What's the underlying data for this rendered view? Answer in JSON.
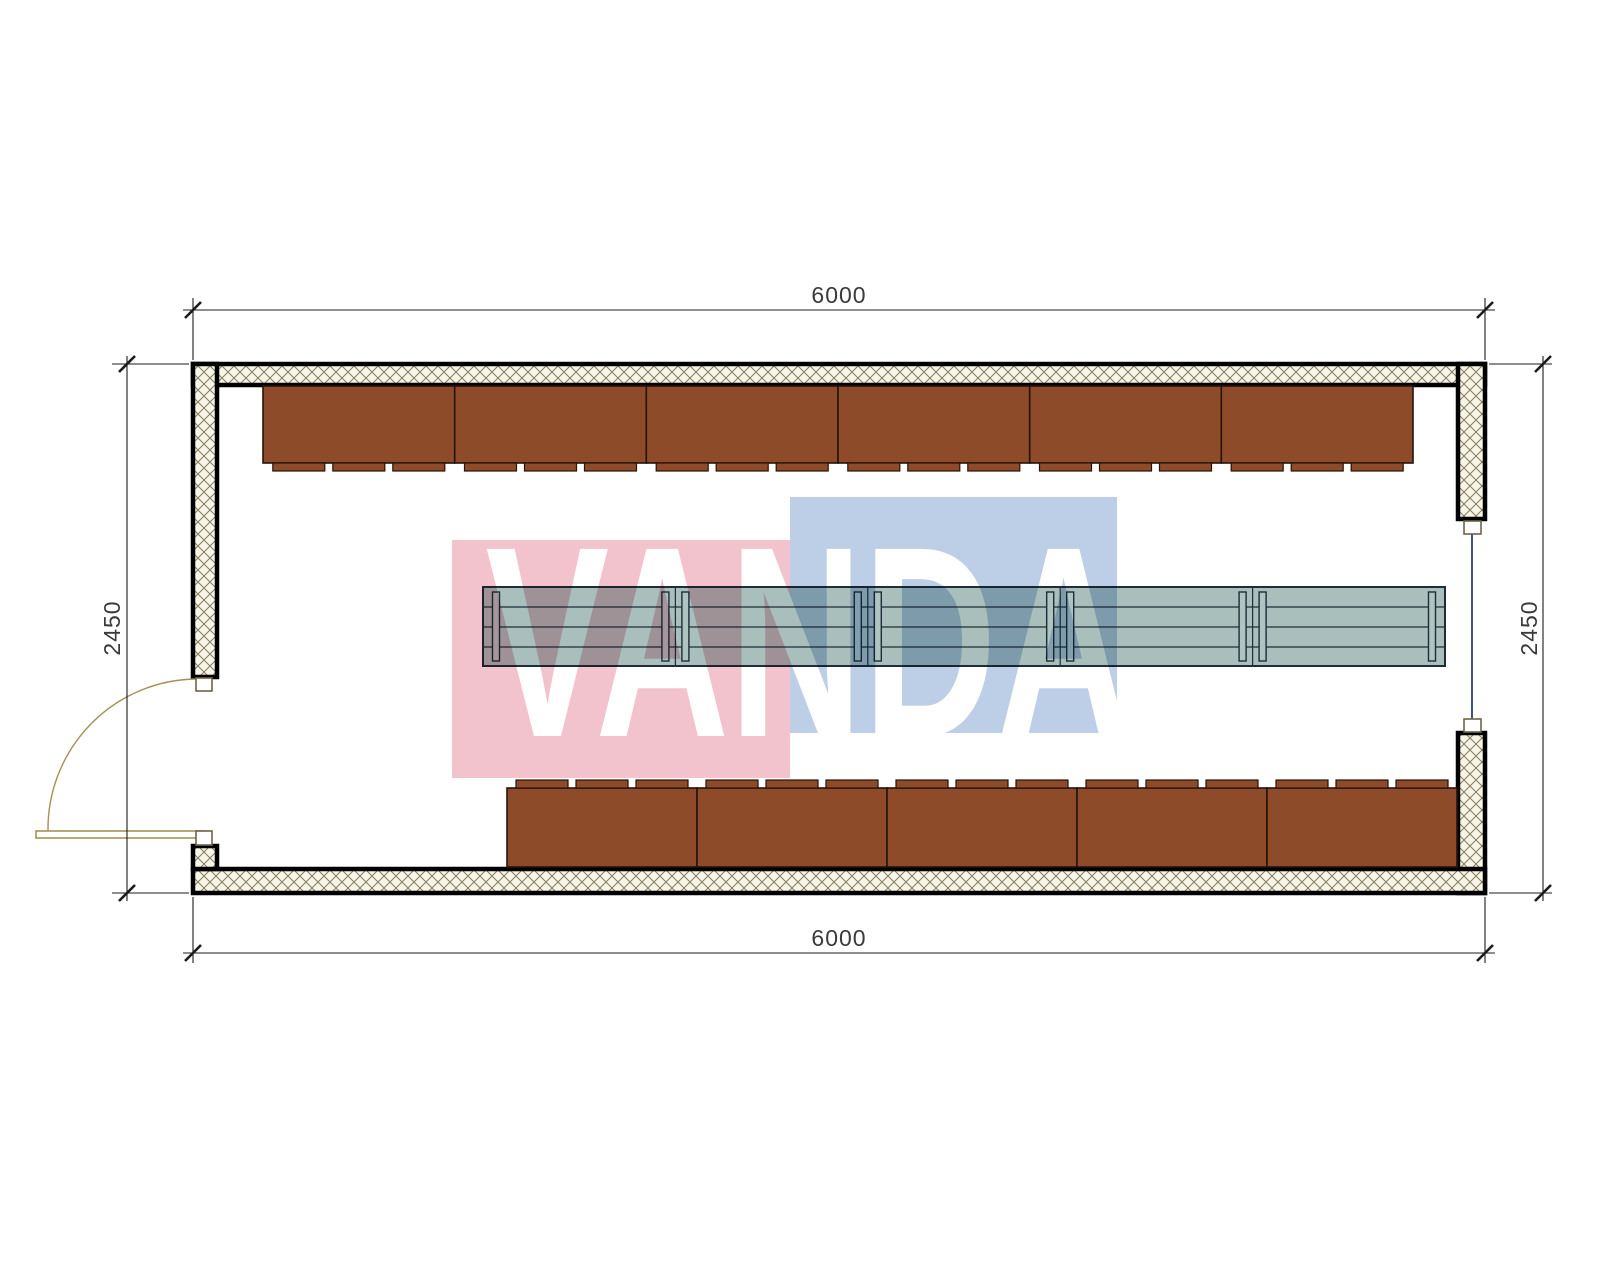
{
  "plan": {
    "dimension_labels": {
      "top": "6000",
      "bottom": "6000",
      "left": "2450",
      "right": "2450"
    },
    "watermark": {
      "text": "VANDA",
      "pink_square_color": "#f2c3cd",
      "blue_square_color": "#bdcfe7"
    },
    "furniture": {
      "top_desk_count": 6,
      "bottom_desk_count": 5,
      "tabs_per_desk": 3,
      "table_segments": 5
    },
    "colors": {
      "desk_fill": "#8d4b29",
      "desk_border": "#26130a",
      "table_fill": "#a8bfbc",
      "table_border": "#1e2d38",
      "table_leg_fill": "#aec4c1",
      "hatch_line": "#857d5e",
      "hatch_bg": "#f7f4e8",
      "wall_border": "#000000",
      "door": "#a39255",
      "window": "#2c3e6b",
      "dim_line": "#1c1c1c",
      "dim_text": "#3a3a3a",
      "frame_border": "#6d6547"
    }
  }
}
